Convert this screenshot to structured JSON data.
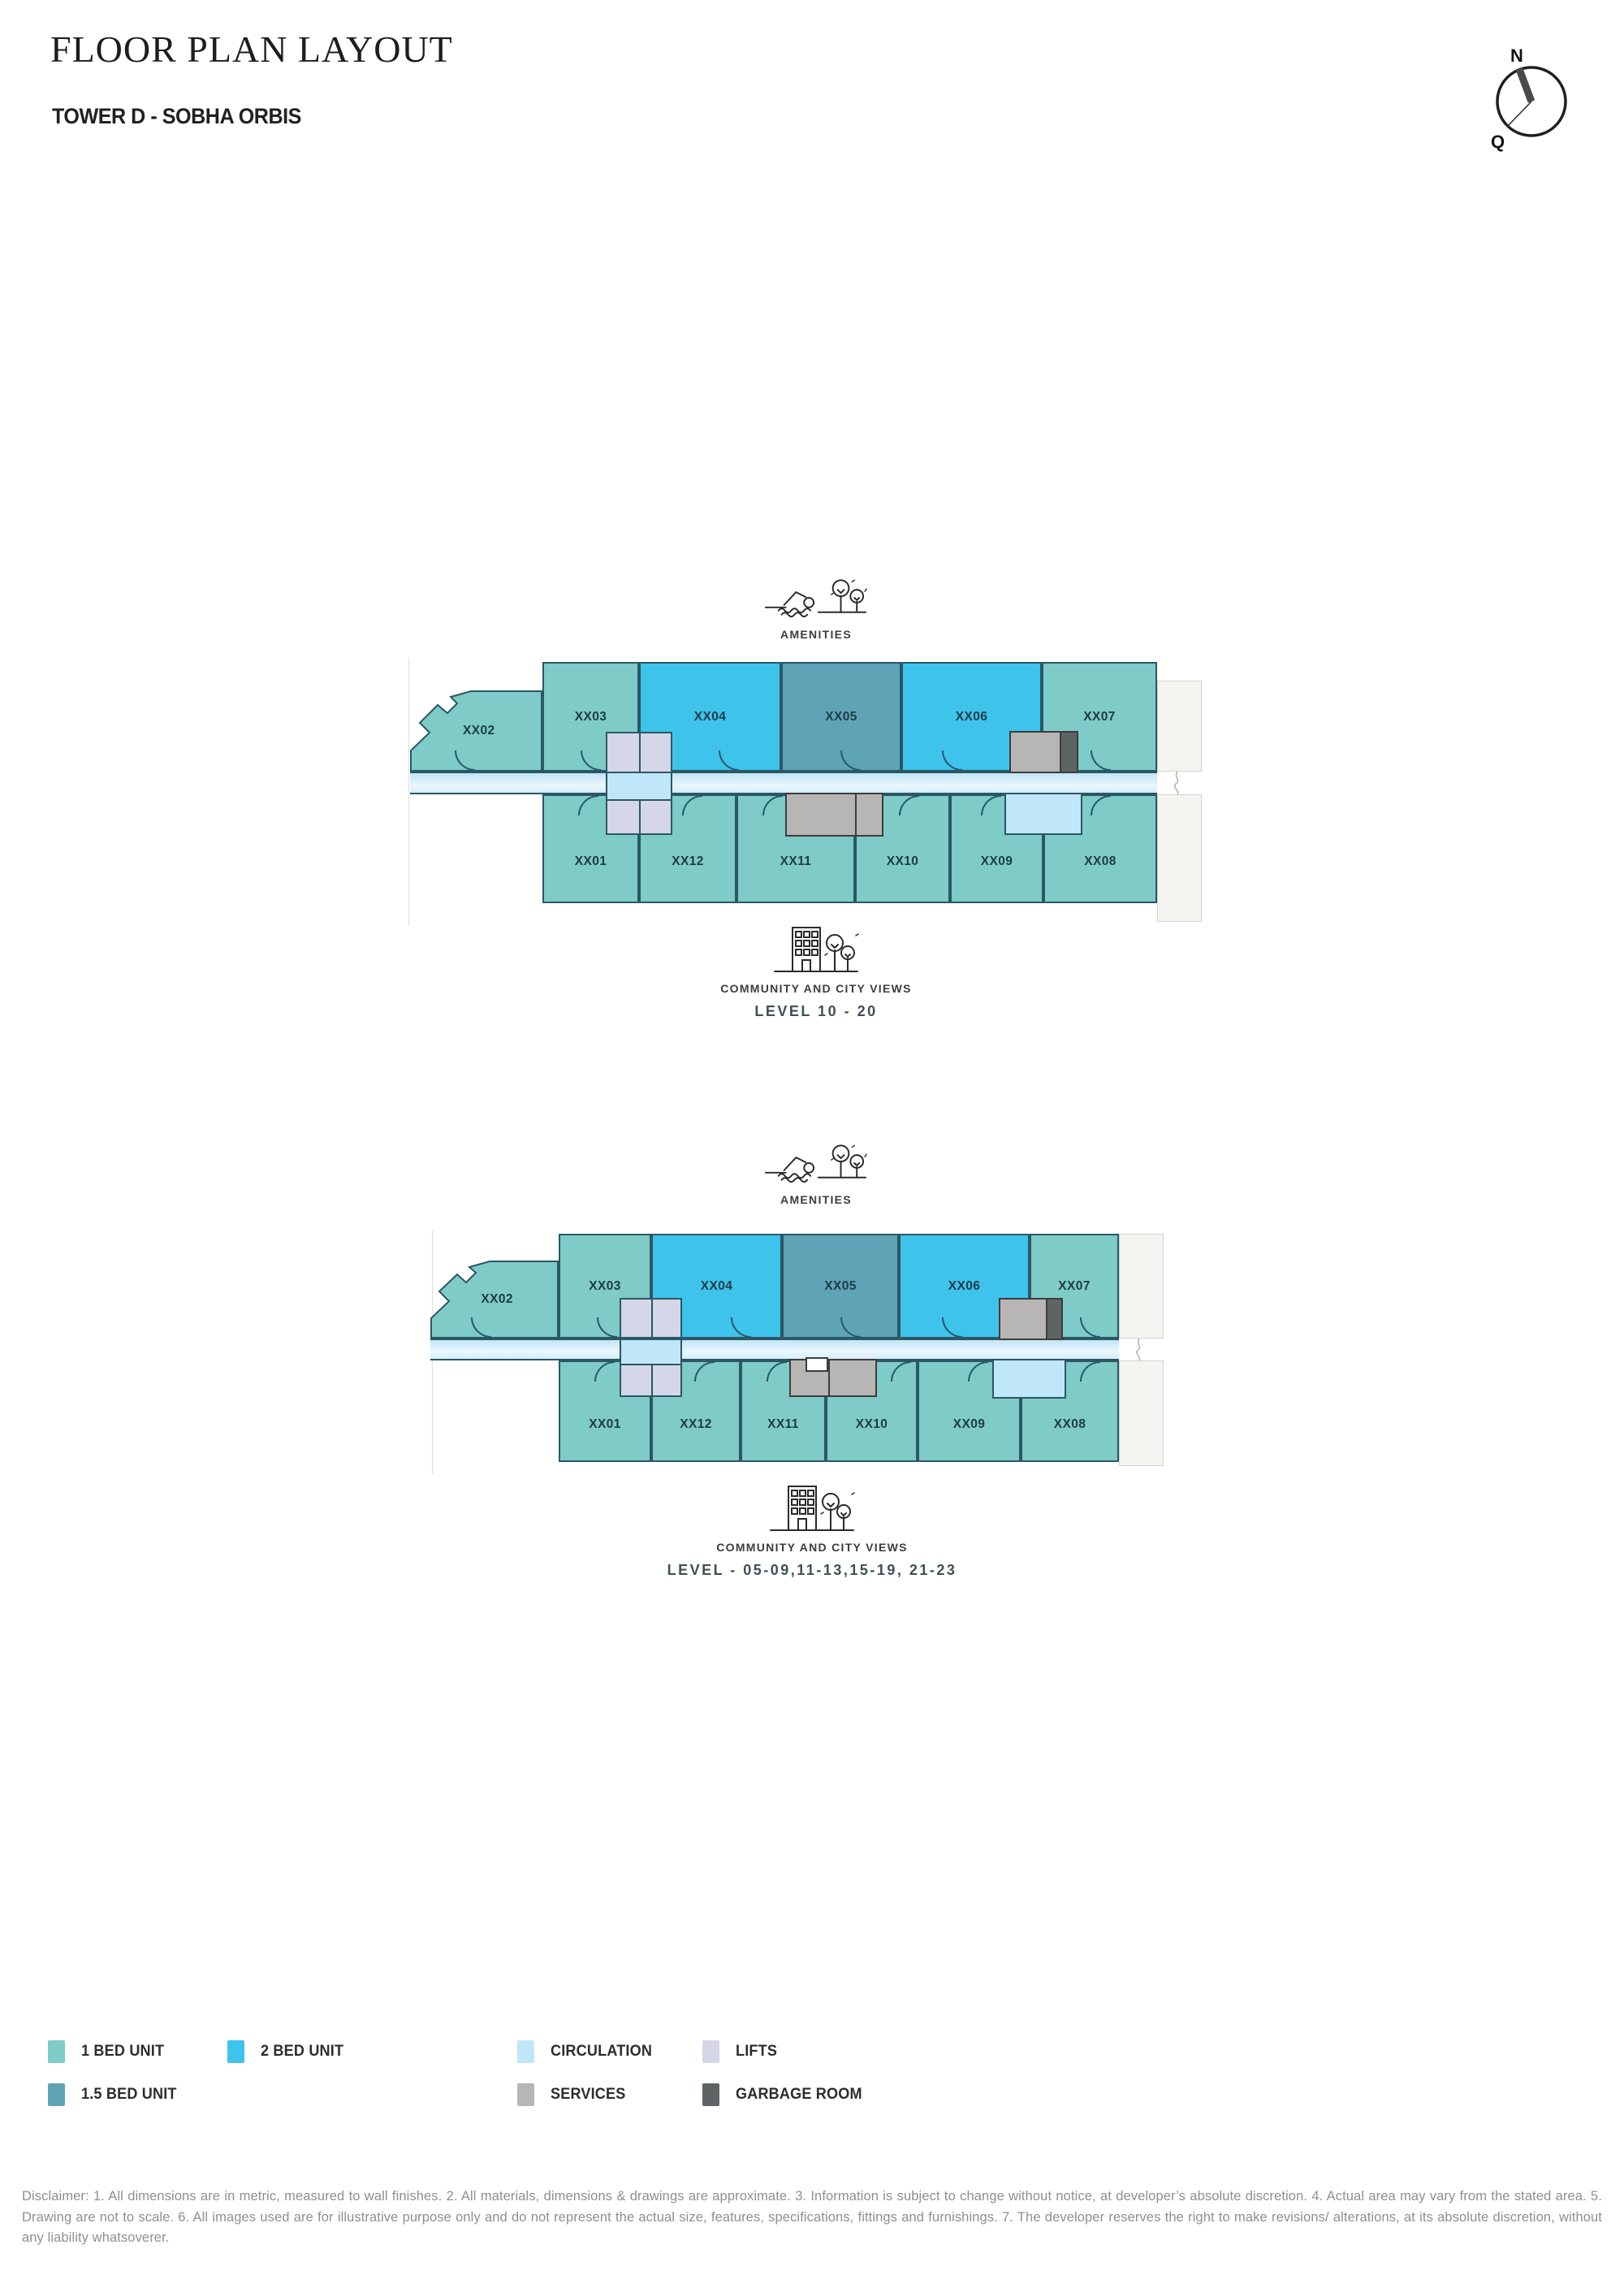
{
  "header": {
    "title": "FLOOR PLAN LAYOUT",
    "subtitle": "TOWER D - SOBHA ORBIS"
  },
  "compass": {
    "north": "N",
    "q": "Q"
  },
  "plans": [
    {
      "amenities": "AMENITIES",
      "views": "COMMUNITY AND CITY VIEWS",
      "level": "LEVEL 10 - 20",
      "top_units": [
        "XX02",
        "XX03",
        "XX04",
        "XX05",
        "XX06",
        "XX07"
      ],
      "bottom_units": [
        "XX01",
        "XX12",
        "XX11",
        "XX10",
        "XX09",
        "XX08"
      ]
    },
    {
      "amenities": "AMENITIES",
      "views": "COMMUNITY AND CITY VIEWS",
      "level": "LEVEL - 05-09,11-13,15-19, 21-23",
      "top_units": [
        "XX02",
        "XX03",
        "XX04",
        "XX05",
        "XX06",
        "XX07"
      ],
      "bottom_units": [
        "XX01",
        "XX12",
        "XX11",
        "XX10",
        "XX09",
        "XX08"
      ]
    }
  ],
  "legend": {
    "items": [
      {
        "key": "one-bed",
        "label": "1 BED UNIT",
        "color": "#7ECBC8"
      },
      {
        "key": "one-half-bed",
        "label": "1.5 BED UNIT",
        "color": "#5FA3B6"
      },
      {
        "key": "two-bed",
        "label": "2 BED UNIT",
        "color": "#3EC3EB"
      },
      {
        "key": "circulation",
        "label": "CIRCULATION",
        "color": "#BFE7F9"
      },
      {
        "key": "services",
        "label": "SERVICES",
        "color": "#B7B6B4"
      },
      {
        "key": "lifts",
        "label": "LIFTS",
        "color": "#D5D6E7"
      },
      {
        "key": "garbage",
        "label": "GARBAGE ROOM",
        "color": "#5E6464"
      }
    ]
  },
  "disclaimer": "Disclaimer: 1. All dimensions are in metric, measured to wall finishes. 2. All materials, dimensions & drawings are approximate. 3. Information is subject to change without notice, at developer’s absolute discretion. 4. Actual area may vary from the stated area. 5. Drawing are not to scale. 6. All images used are for illustrative purpose only and do not represent the actual size, features, specifications, fittings and furnishings. 7. The developer reserves the right to make revisions/ alterations, at its absolute discretion, without any liability whatsoverer."
}
